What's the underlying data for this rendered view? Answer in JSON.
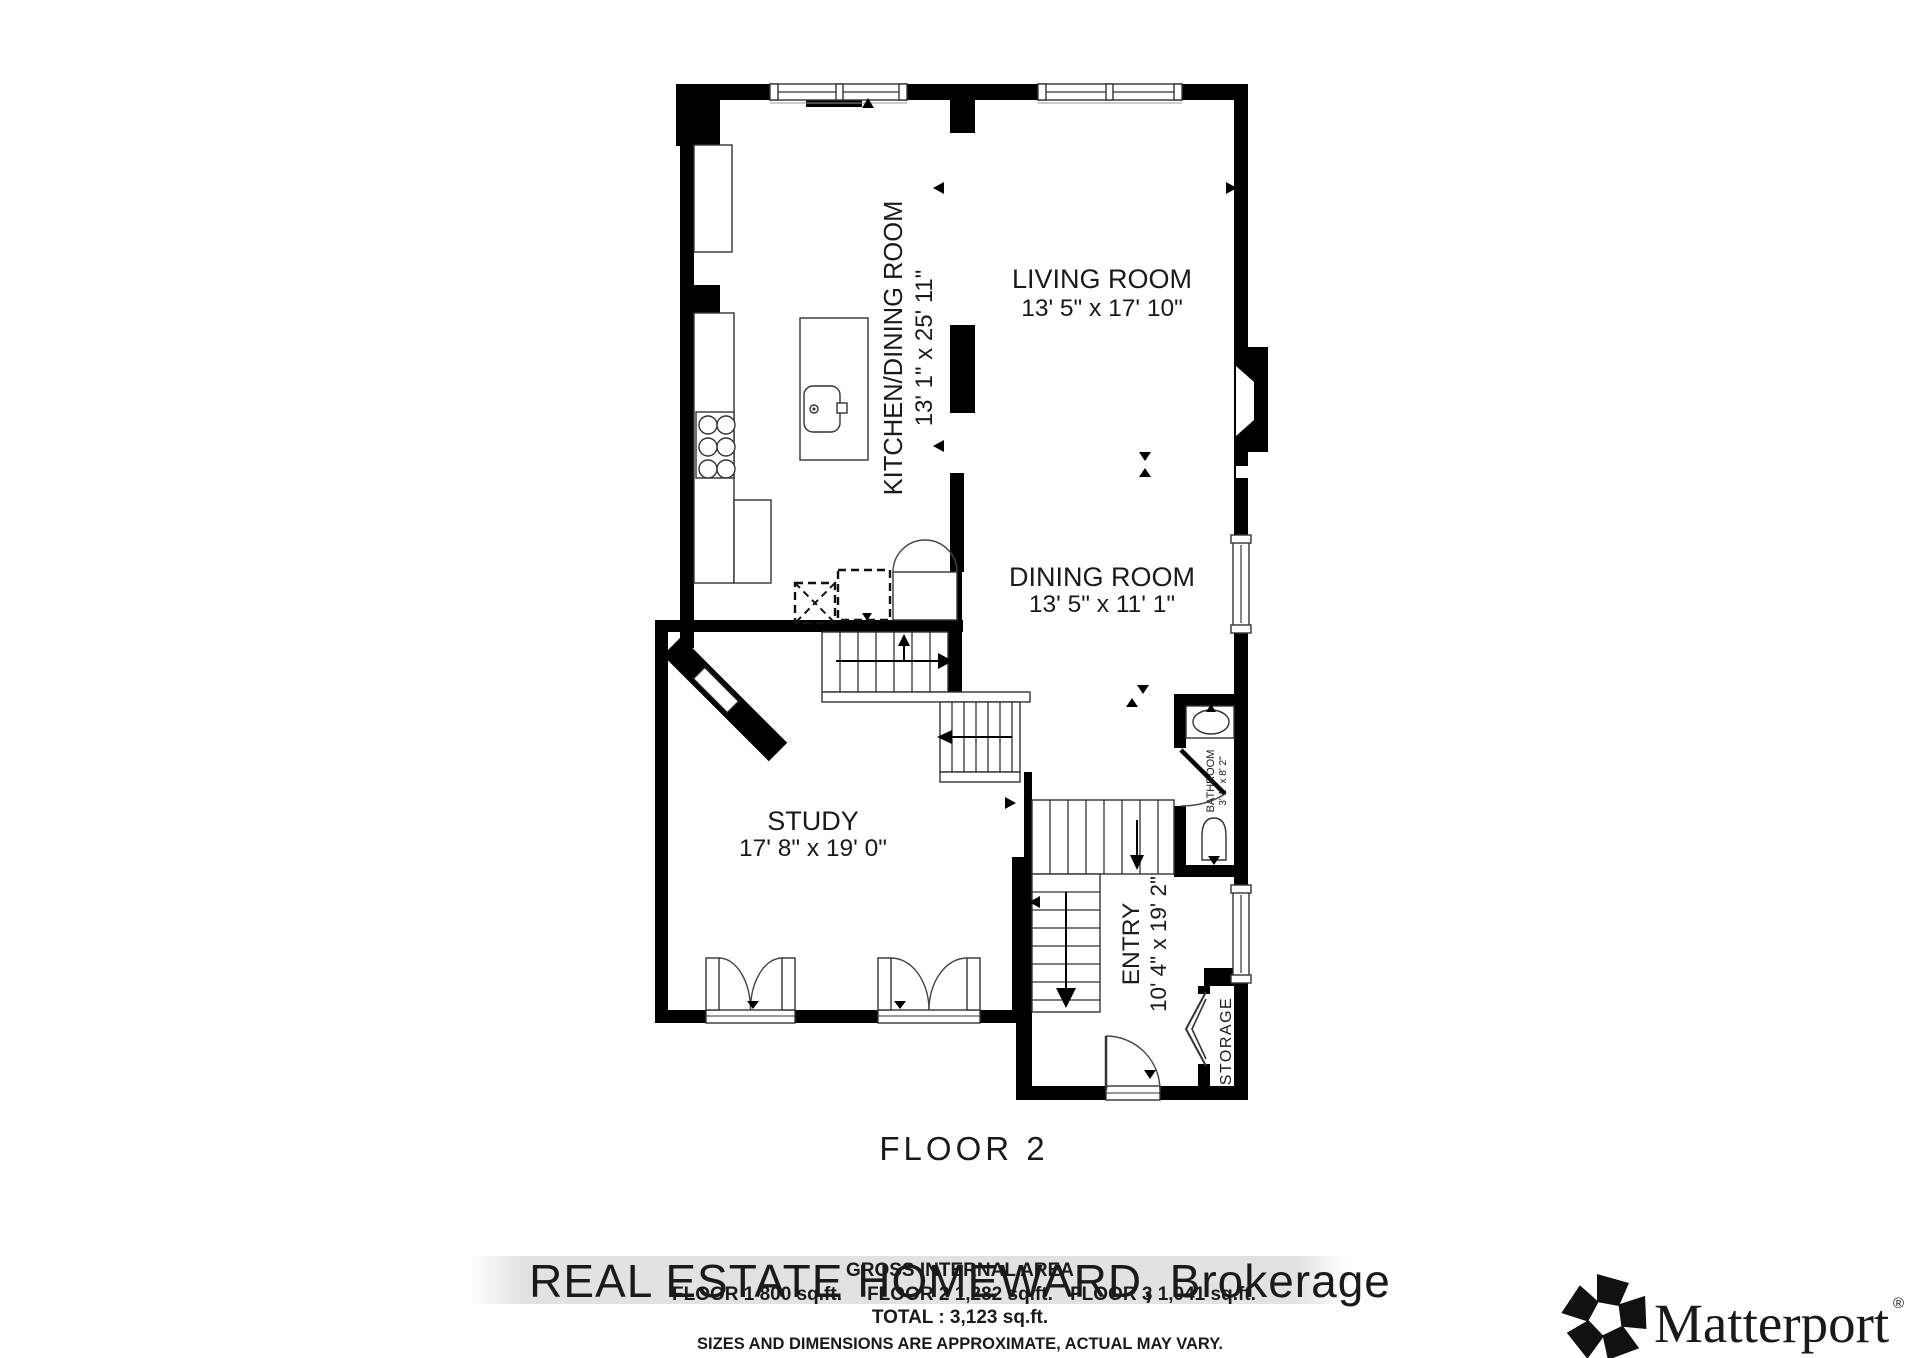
{
  "title": "FLOOR 2",
  "rooms": {
    "kitchen_dining": {
      "name": "KITCHEN/DINING ROOM",
      "dims": "13' 1\" x 25' 11\""
    },
    "living": {
      "name": "LIVING ROOM",
      "dims": "13' 5\" x 17' 10\""
    },
    "dining": {
      "name": "DINING ROOM",
      "dims": "13' 5\" x 11' 1\""
    },
    "study": {
      "name": "STUDY",
      "dims": "17' 8\" x 19' 0\""
    },
    "entry": {
      "name": "ENTRY",
      "dims": "10' 4\" x 19' 2\""
    },
    "bathroom": {
      "name": "BATHROOM",
      "dims": "3' 1\" x 8' 2\""
    },
    "storage": {
      "name": "STORAGE"
    }
  },
  "footer": {
    "watermark": "REAL ESTATE HOMEWARD, Brokerage",
    "gross_area_title": "GROSS INTERNAL AREA",
    "floor1_area": "FLOOR 1 800 sq.ft.",
    "floor2_area": "FLOOR 2 1,282 sq.ft.",
    "floor3_area": "FLOOR 3 1,041 sq.ft.",
    "total_area": "TOTAL :  3,123 sq.ft.",
    "disclaimer": "SIZES AND DIMENSIONS ARE APPROXIMATE, ACTUAL MAY VARY."
  },
  "branding": {
    "name": "Matterport",
    "registered_mark": "®"
  },
  "colors": {
    "wall": "#000000",
    "floor": "#ffffff",
    "label_text": "#1a1a1a",
    "watermark_text": "#f7f7f7",
    "watermark_band": "#e2e2e2"
  }
}
